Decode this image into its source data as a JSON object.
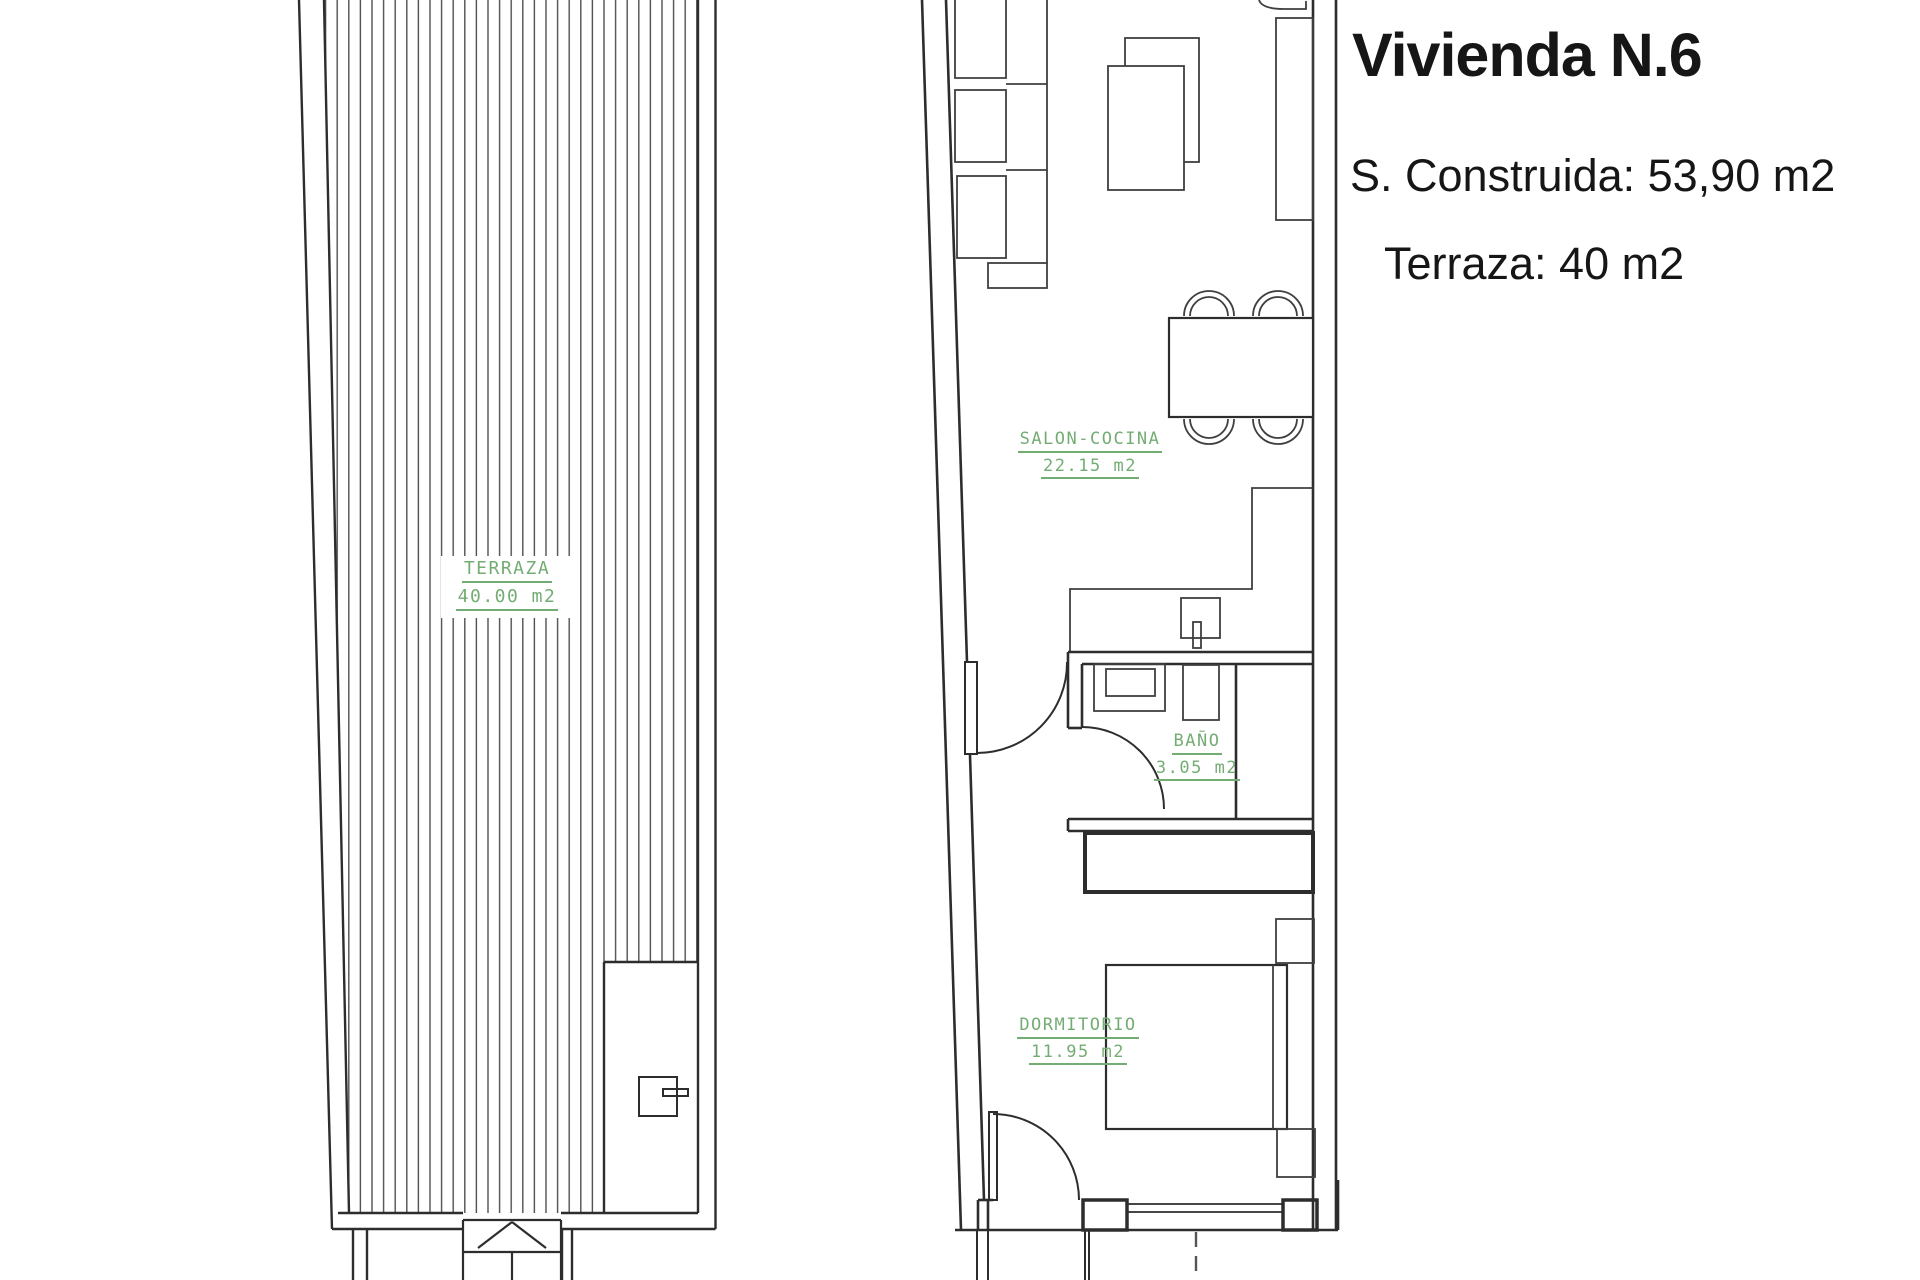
{
  "info_panel": {
    "title": "Vivienda N.6",
    "built_area": "S. Construida: 53,90 m2",
    "terrace_area": "Terraza: 40 m2"
  },
  "rooms": {
    "terraza": {
      "name": "TERRAZA",
      "area": "40.00 m2"
    },
    "salon": {
      "name": "SALON-COCINA",
      "area": "22.15 m2"
    },
    "bano": {
      "name": "BAÑO",
      "area": "3.05 m2"
    },
    "dormitorio": {
      "name": "DORMITORIO",
      "area": "11.95 m2"
    }
  },
  "colors": {
    "label_green": "#74ad74",
    "wall_line": "#2d2d2d",
    "furniture_line": "#454545",
    "hatch_line": "#4f4f4f"
  }
}
